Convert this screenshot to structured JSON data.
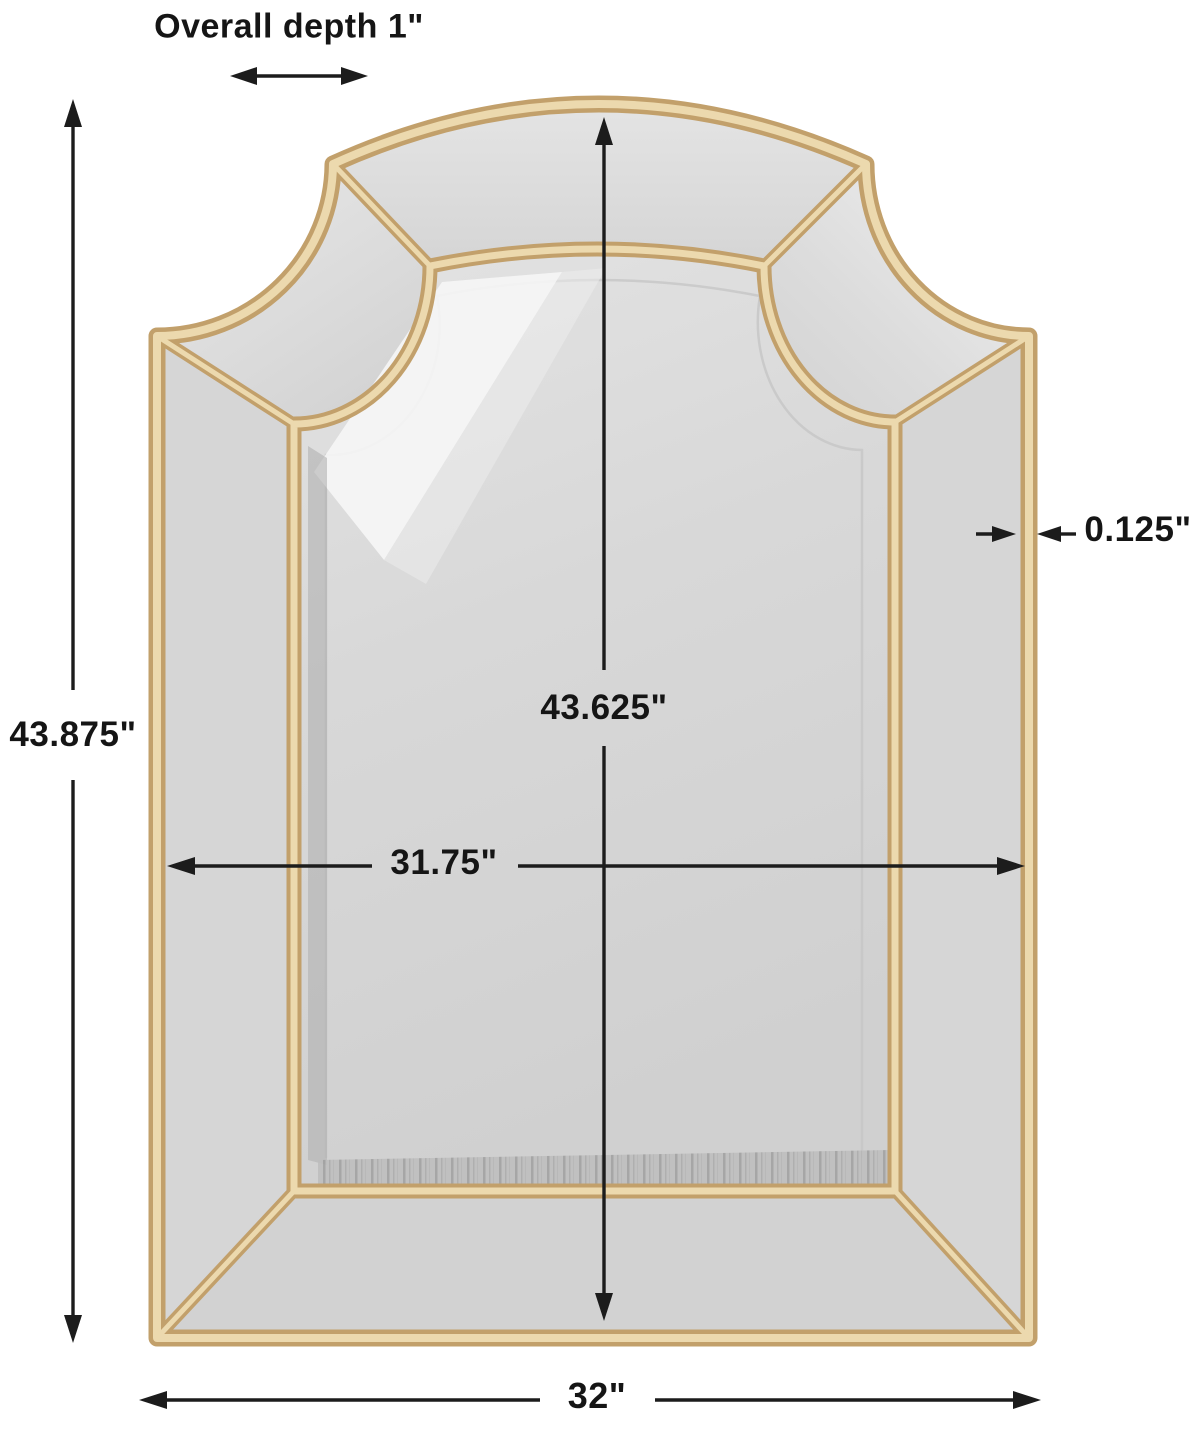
{
  "page": {
    "title": "Arched wall mirror dimension diagram"
  },
  "product": {
    "name": "Arched gold-frame panel wall mirror"
  },
  "dimensions": {
    "overall_depth": "Overall depth 1\"",
    "overall_height": "43.875\"",
    "mirror_height": "43.625\"",
    "mirror_width": "31.75\"",
    "frame_thickness": "0.125\"",
    "overall_width": "32\""
  },
  "colors": {
    "background": "#ffffff",
    "frame_gold_dark": "#c2a06b",
    "frame_gold_light": "#ecd9ae",
    "mirror_glass": "#d6d6d6",
    "dimension_lines": "#1c1c1c"
  }
}
